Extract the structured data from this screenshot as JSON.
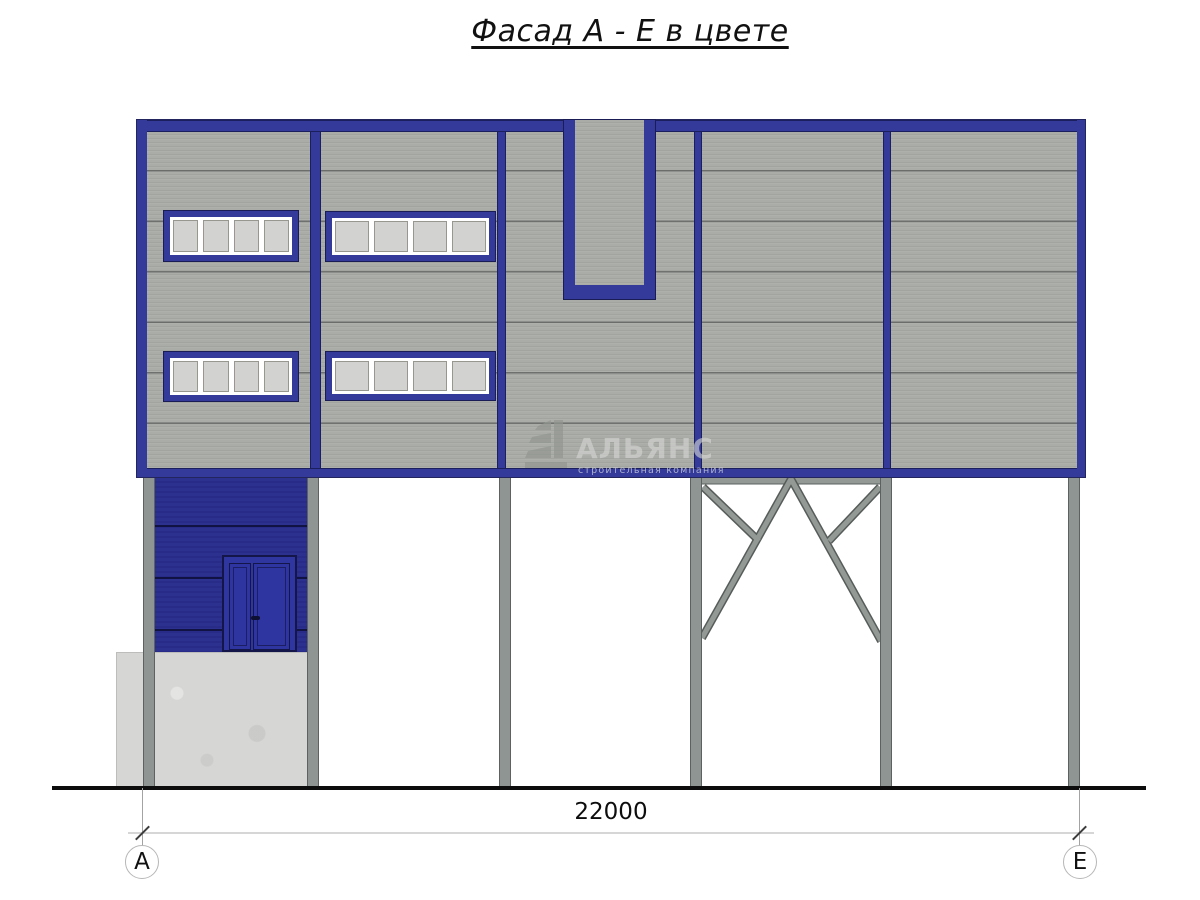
{
  "title": "Фасад А - Е в цвете",
  "dimension": {
    "span_label": "22000"
  },
  "axis_markers": {
    "left": "А",
    "right": "Е"
  },
  "watermark": {
    "company": "АЛЬЯНС",
    "tagline": "строительная компания"
  },
  "colors": {
    "frame_blue": "#343a99",
    "wall_blue": "#2b2f8f",
    "door_blue": "#3036a0",
    "panel_gray": "#a8aaa6",
    "column_gray": "#8e9592",
    "foundation_gray": "#d6d6d4",
    "ground_black": "#0d0d0d"
  }
}
